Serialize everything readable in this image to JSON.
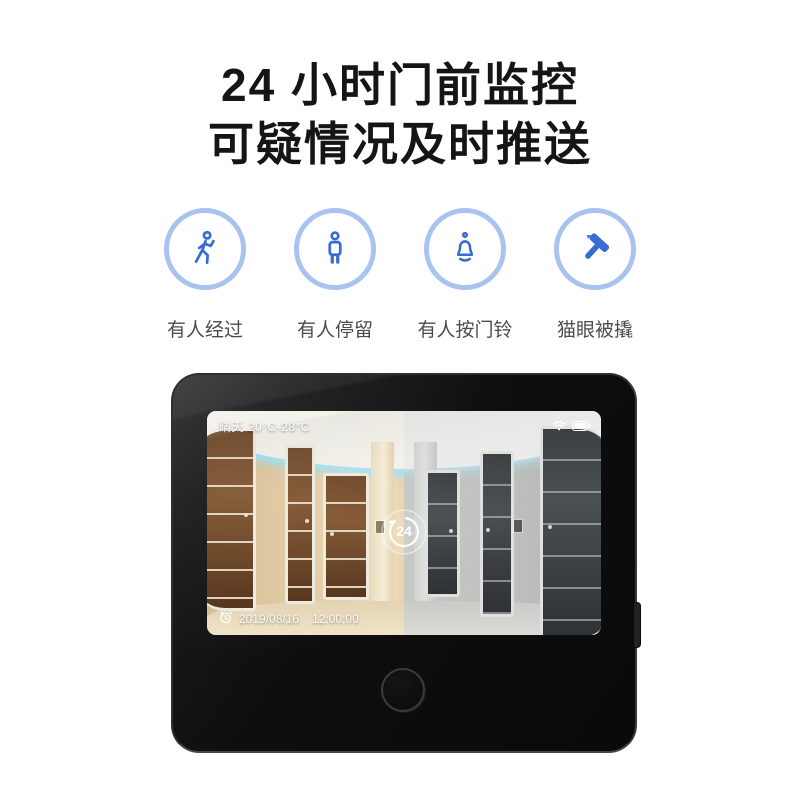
{
  "title": {
    "line1": "24 小时门前监控",
    "line2": "可疑情况及时推送"
  },
  "features": [
    {
      "icon": "walking-person-icon",
      "label": "有人经过"
    },
    {
      "icon": "standing-person-icon",
      "label": "有人停留"
    },
    {
      "icon": "doorbell-icon",
      "label": "有人按门铃"
    },
    {
      "icon": "hammer-icon",
      "label": "猫眼被撬"
    }
  ],
  "device": {
    "name": "smart-peephole-monitor",
    "screen": {
      "weather": "晴天 20°C-28°C",
      "status_icons": [
        "wifi-icon",
        "battery-icon"
      ],
      "badge_icon": "24-hour-loop-icon",
      "badge_label": "24",
      "date": "2019/08/16",
      "time": "12:00:00"
    }
  },
  "colors": {
    "accent_blue": "#3a6ad4",
    "circle_border": "#a9c3f0",
    "label_gray": "#4c4c4c",
    "title_black": "#151515",
    "device_black": "#0d0d0d",
    "cove_glow": "#bfeafc"
  }
}
